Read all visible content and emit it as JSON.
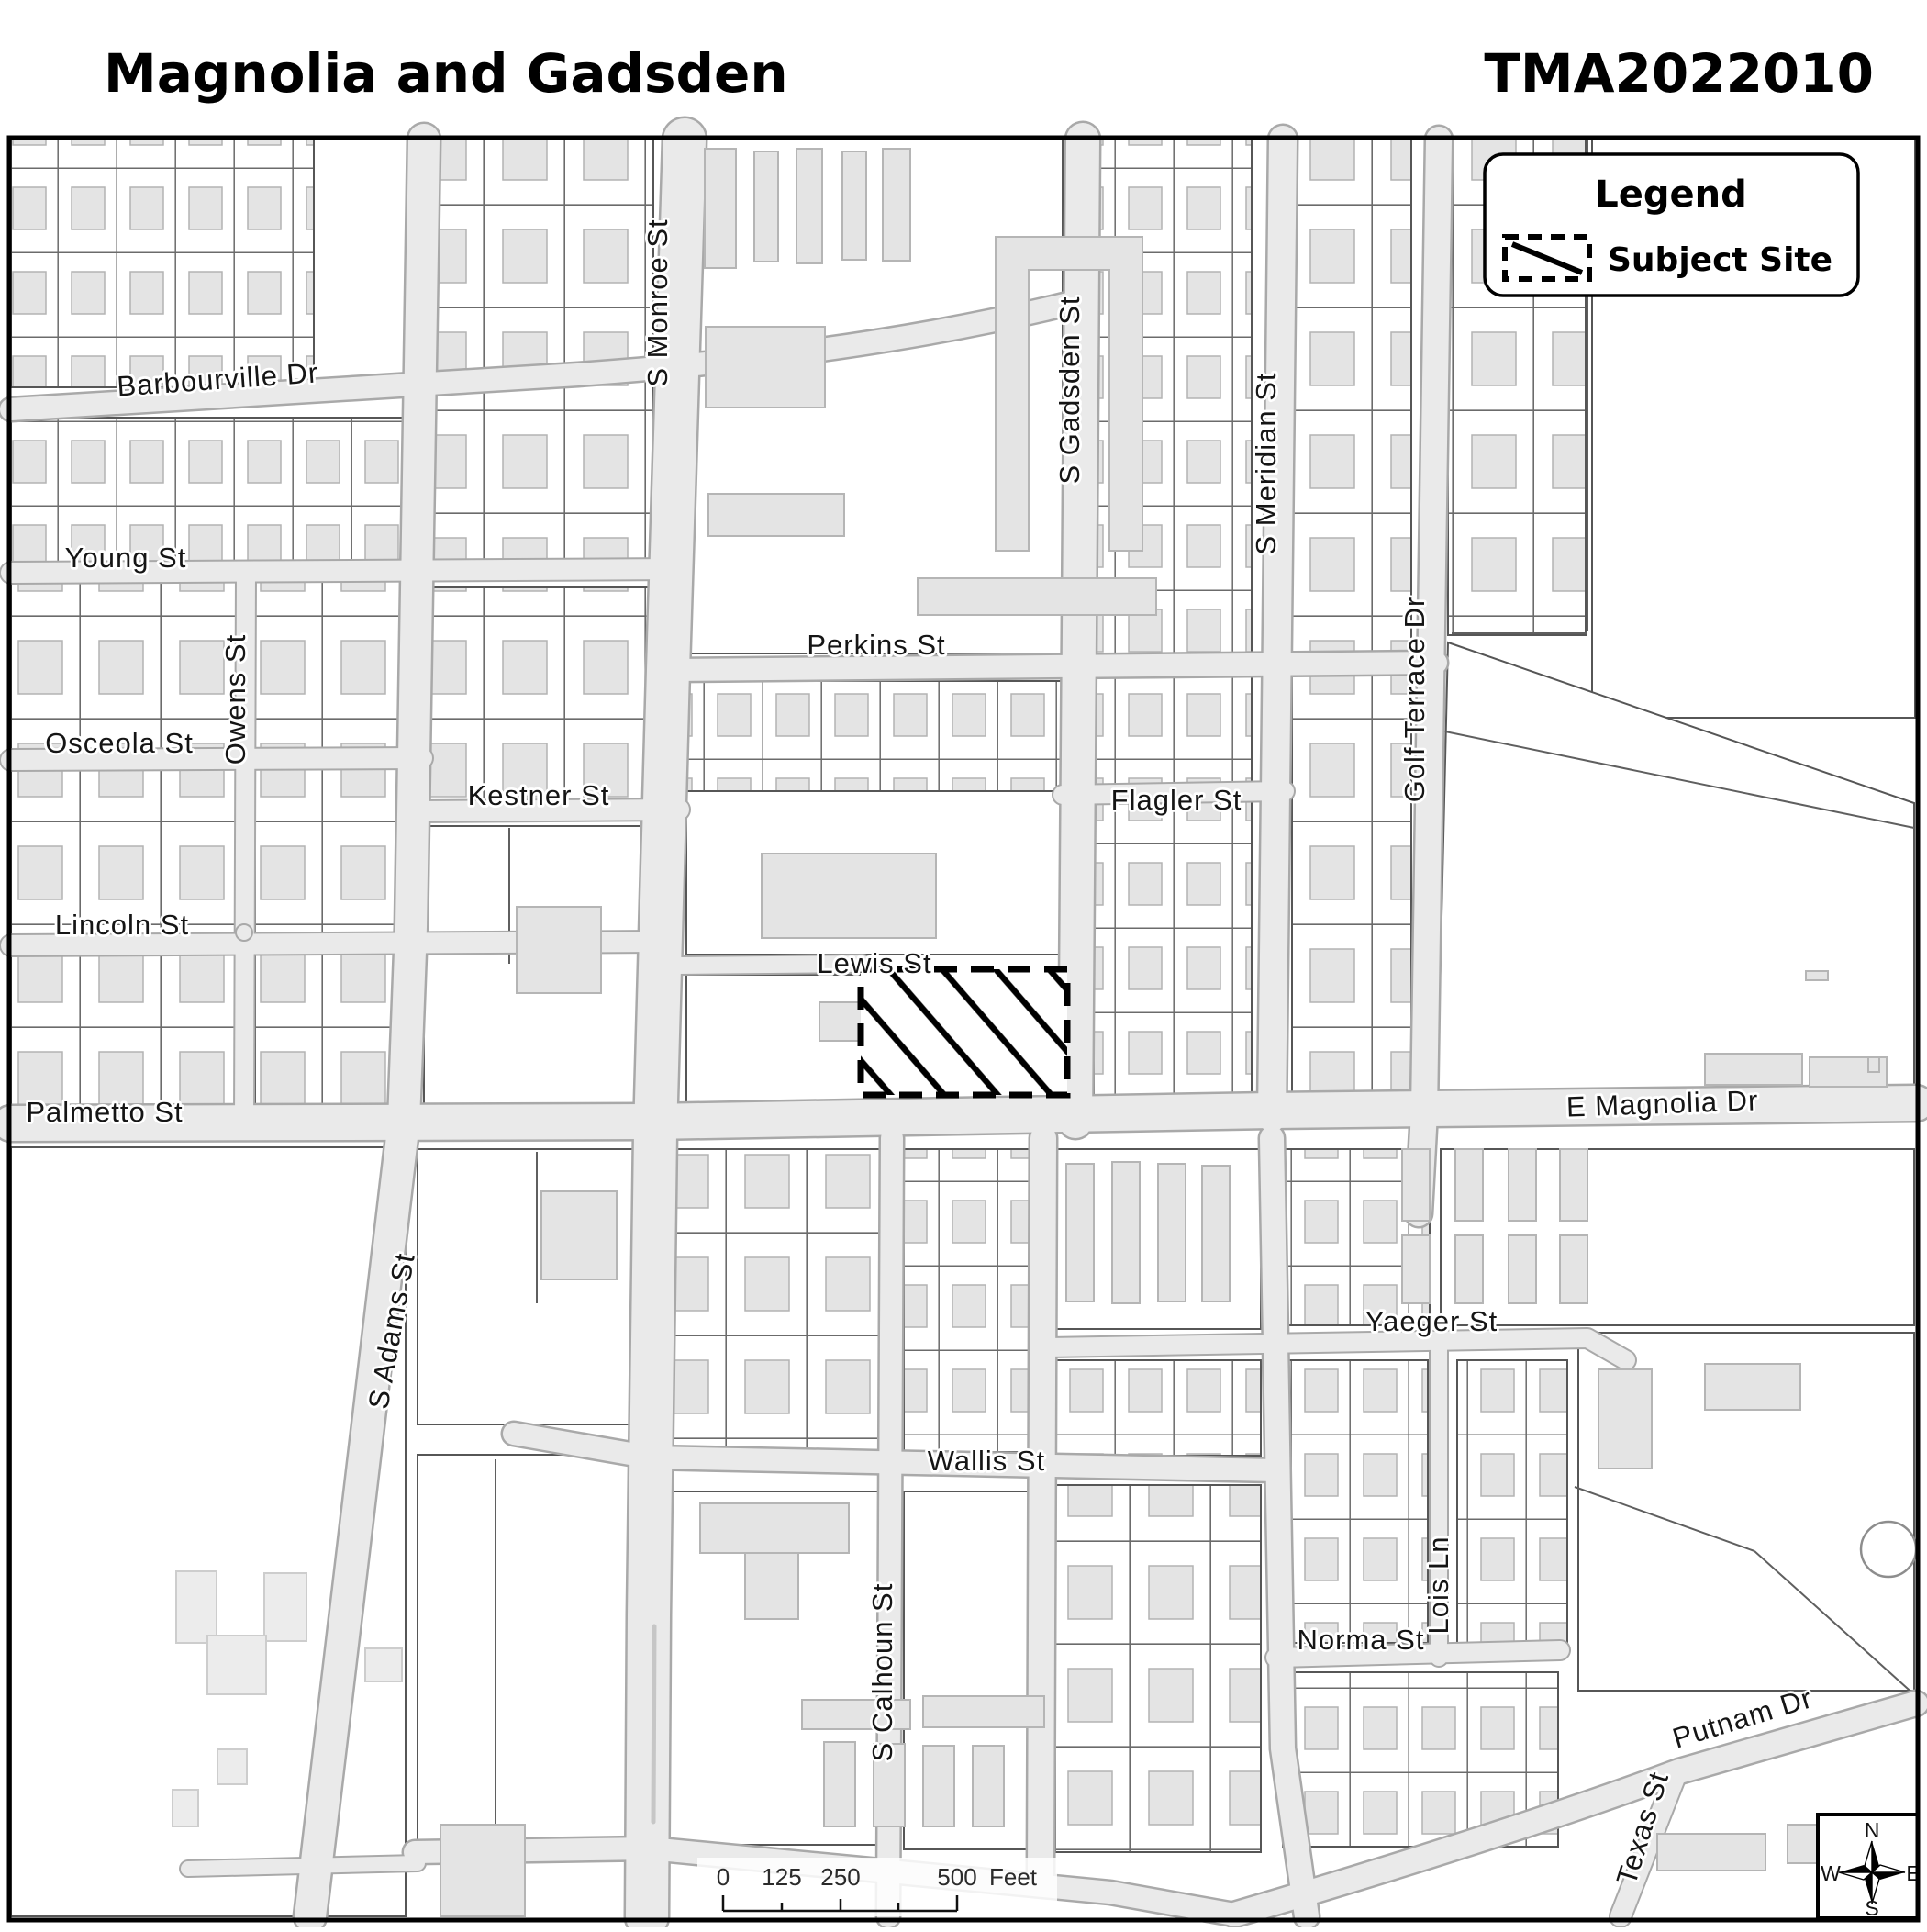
{
  "header": {
    "title": "Magnolia and Gadsden",
    "project_id": "TMA2022010"
  },
  "legend": {
    "title": "Legend",
    "items": [
      {
        "label": "Subject Site",
        "symbol": "dashed-hatched-polygon"
      }
    ]
  },
  "map": {
    "street_labels": [
      {
        "text": "Barbourville Dr"
      },
      {
        "text": "Young St"
      },
      {
        "text": "Owens St"
      },
      {
        "text": "Osceola St"
      },
      {
        "text": "Kestner St"
      },
      {
        "text": "Lincoln St"
      },
      {
        "text": "Palmetto St"
      },
      {
        "text": "S Adams St"
      },
      {
        "text": "S Monroe St"
      },
      {
        "text": "Perkins St"
      },
      {
        "text": "Lewis St"
      },
      {
        "text": "S Gadsden St"
      },
      {
        "text": "Flagler St"
      },
      {
        "text": "S Meridian St"
      },
      {
        "text": "Golf Terrace Dr"
      },
      {
        "text": "E Magnolia Dr"
      },
      {
        "text": "S Calhoun St"
      },
      {
        "text": "Wallis St"
      },
      {
        "text": "Yaeger St"
      },
      {
        "text": "Lois Ln"
      },
      {
        "text": "Norma St"
      },
      {
        "text": "Putnam Dr"
      },
      {
        "text": "Texas St"
      }
    ]
  },
  "scale_bar": {
    "tick_labels": [
      "0",
      "125",
      "250",
      "500"
    ],
    "unit_label": "Feet"
  },
  "compass": {
    "north": "N",
    "east": "E",
    "south": "S",
    "west": "W"
  },
  "colors": {
    "road_fill": "#eaeaea",
    "road_casing": "#a9a9a9",
    "parcel_line": "#565656",
    "building_fill": "#e4e4e4",
    "site_outline": "#000000",
    "frame": "#000000"
  }
}
